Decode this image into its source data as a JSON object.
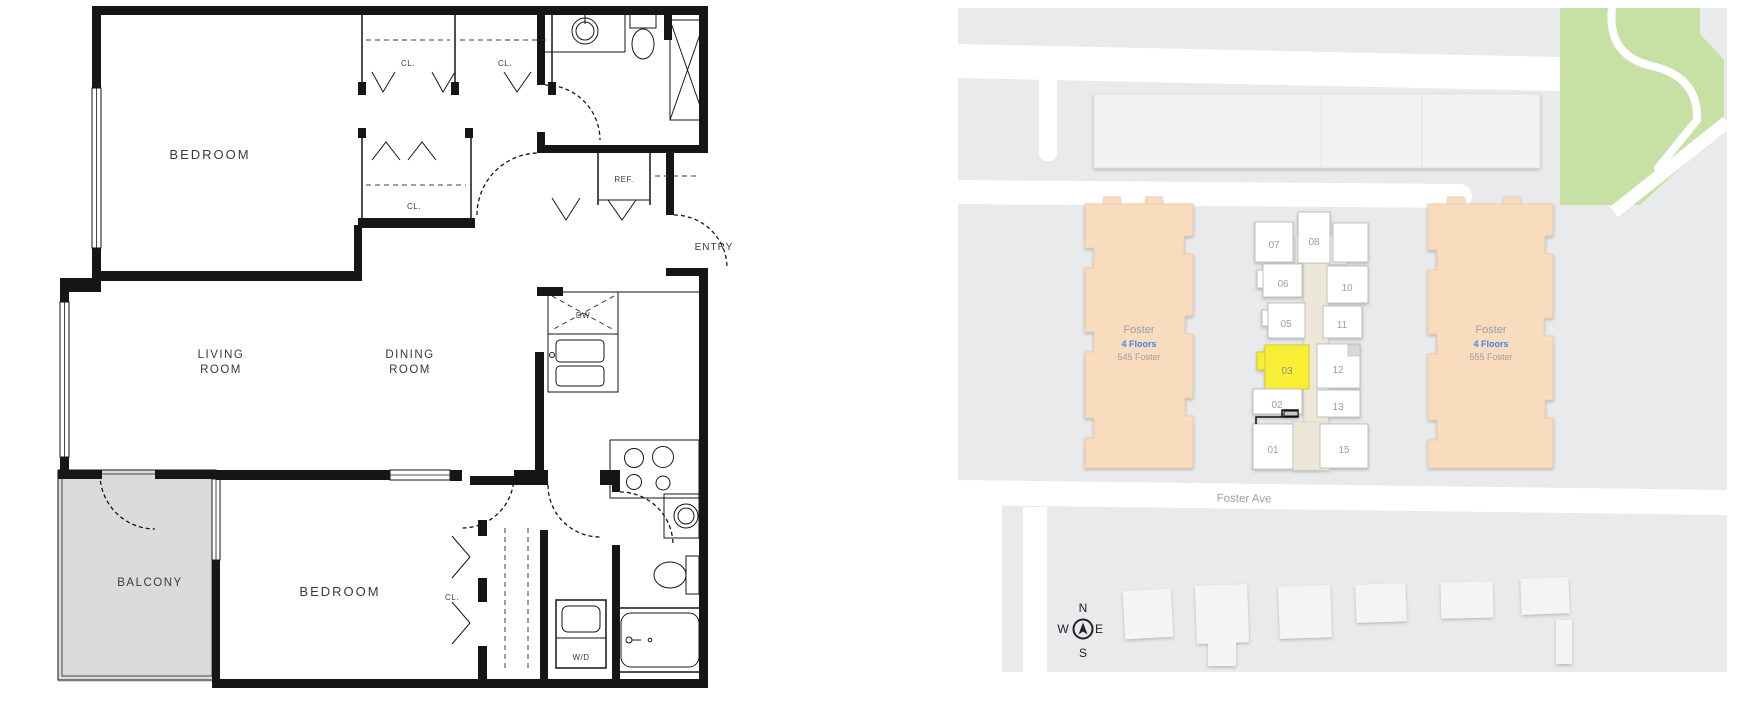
{
  "floor_plan": {
    "labels": {
      "bedroom_top": "BEDROOM",
      "bedroom_bottom": "BEDROOM",
      "living_1": "LIVING",
      "living_2": "ROOM",
      "dining_1": "DINING",
      "dining_2": "ROOM",
      "balcony": "BALCONY",
      "entry": "ENTRY",
      "closet_1": "CL.",
      "closet_2": "CL.",
      "closet_3": "CL.",
      "closet_4": "CL.",
      "fridge": "REF.",
      "dishwasher": "DW",
      "washer_dryer": "W/D"
    }
  },
  "site_map": {
    "street_label": "Foster Ave",
    "highlighted_unit": "03",
    "buildings": [
      {
        "name": "Foster",
        "floors": "4 Floors",
        "address": "545 Foster"
      },
      {
        "name": "Foster",
        "floors": "4 Floors",
        "address": "555 Foster"
      }
    ],
    "units": [
      {
        "number": "07"
      },
      {
        "number": "08"
      },
      {
        "number": "06"
      },
      {
        "number": "10"
      },
      {
        "number": "05"
      },
      {
        "number": "11"
      },
      {
        "number": "03"
      },
      {
        "number": "12"
      },
      {
        "number": "02"
      },
      {
        "number": "13"
      },
      {
        "number": "01"
      },
      {
        "number": "15"
      }
    ],
    "compass": {
      "n": "N",
      "w": "W",
      "e": "E",
      "s": "S"
    },
    "colors": {
      "building_peach": "#F9DBBD",
      "unit_highlight_yellow": "#F8EE35",
      "park_green": "#C7E1A4",
      "corridor_beige": "#EDE7D8",
      "map_background": "#E9EAEB",
      "road_white": "#FFFFFF",
      "label_gray": "#9AA0A6",
      "floors_blue": "#4285F4"
    }
  }
}
